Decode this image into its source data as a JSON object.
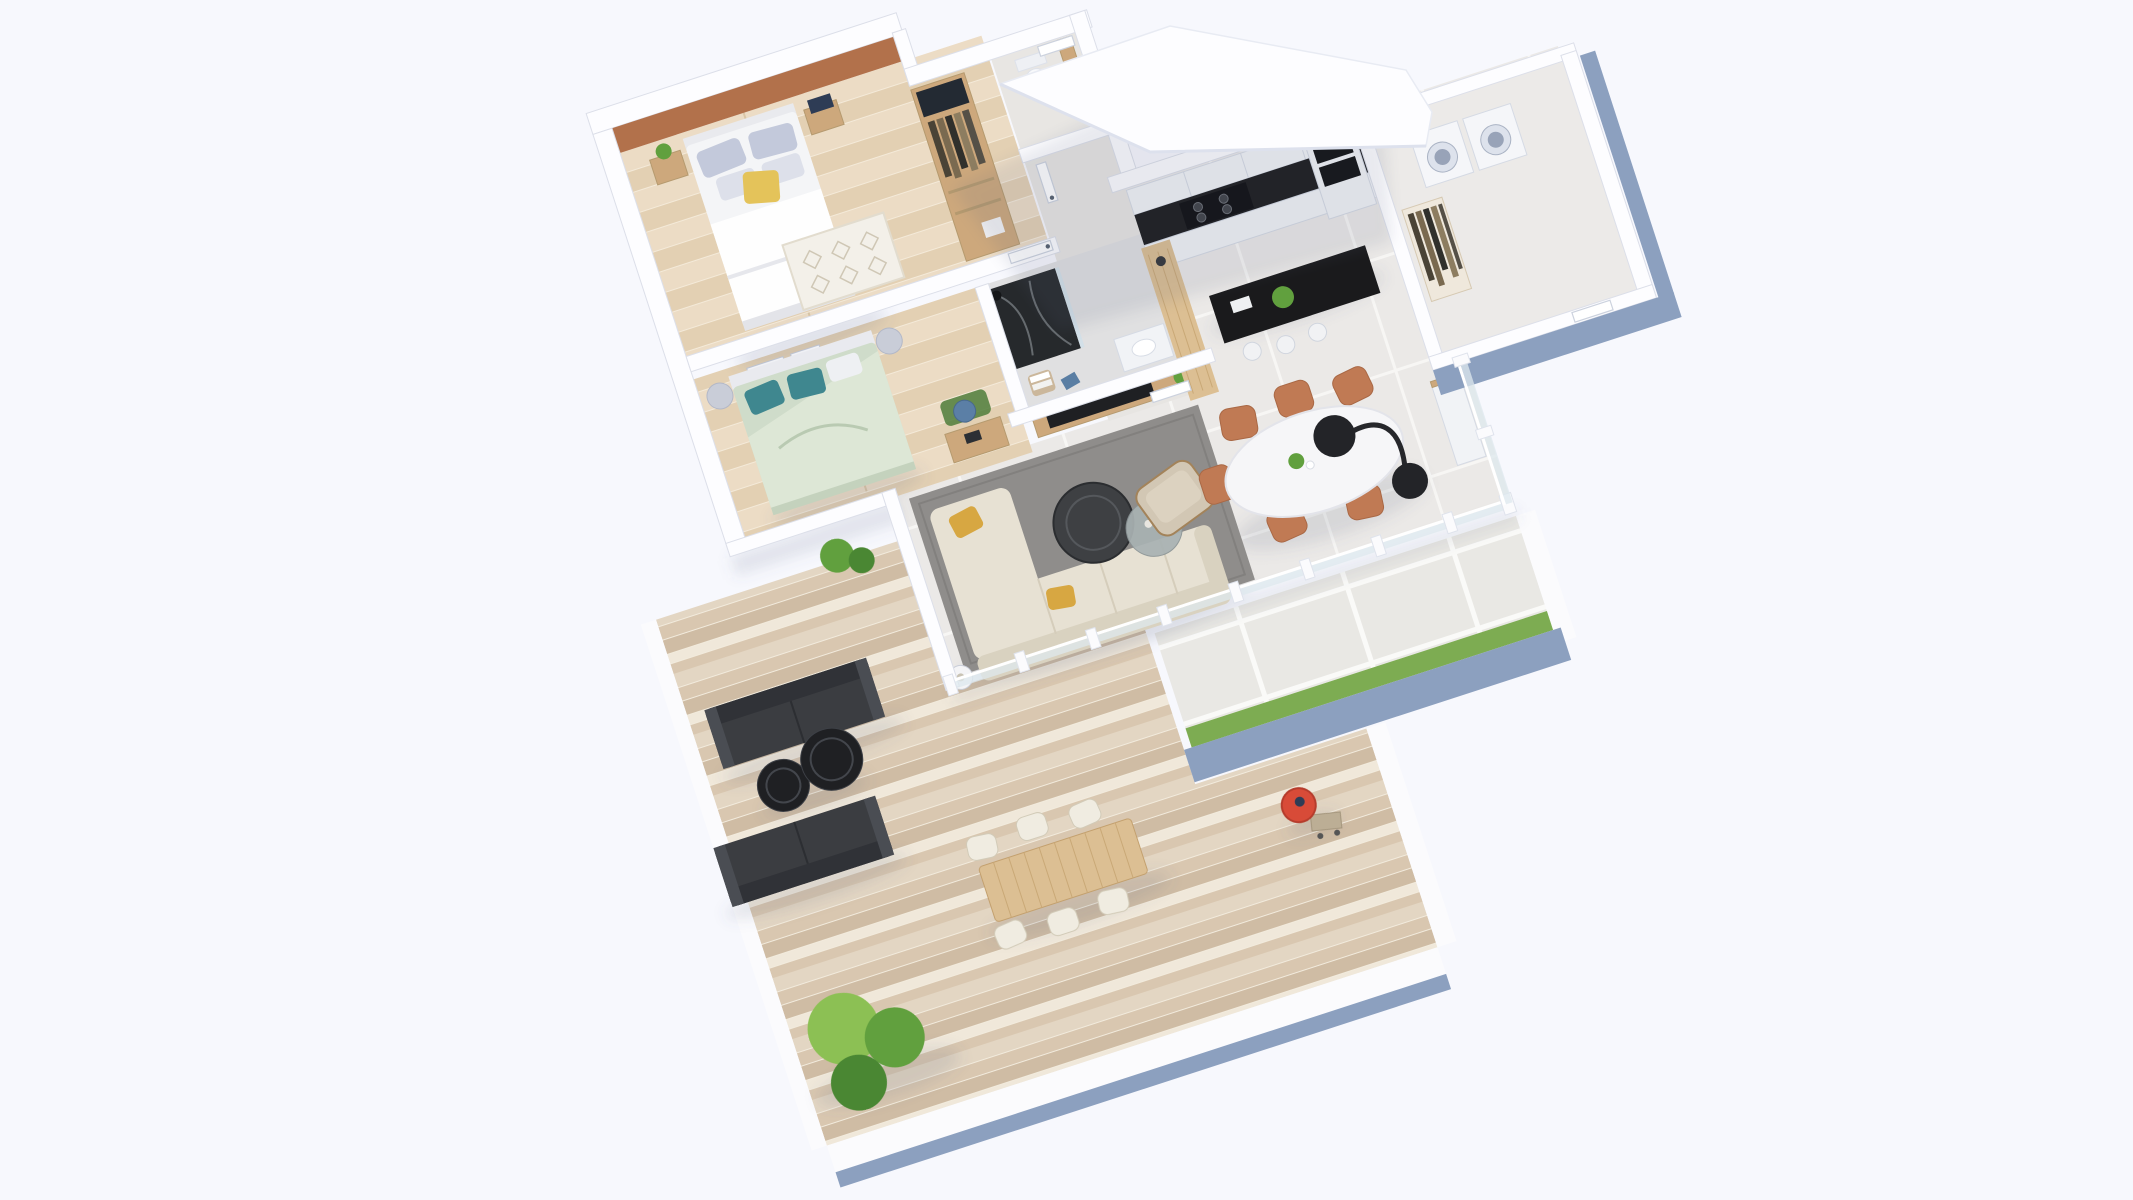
{
  "scene": {
    "type": "isometric-3d-floor-plan-render",
    "description": "Photorealistic 3D floor plan of an apartment with two bedrooms, bathroom, WC, kitchen, laundry room, open living-dining area, large wooden terrace deck and paver patio, viewed from above at an angle, rotated about -18 degrees on a pale background. No text labels are visible.",
    "rotation_deg": -18,
    "palette": {
      "background": "#f7f8fd",
      "wallTop": "#fdfdff",
      "slate": "#8ca0bf",
      "orange": "#b2714b",
      "tileFloor": "#ebe9e7",
      "hallFloor": "#e7e5e2",
      "woodFloorA": "#ecdcc5",
      "woodFloorB": "#e3d0b3",
      "deckA": "#e3d6c3",
      "deckB": "#d9c7b0",
      "deckC": "#cfbca4",
      "deckD": "#f0e8da",
      "paver": "#e9e8e4",
      "grass": "#7dac52",
      "rugGray": "#8f8d8b",
      "rugWhite": "#f3f0e9",
      "sofaCream": "#e7e1d3",
      "sofaCreamDark": "#d9d2c0",
      "mustard": "#d7a742",
      "bedWhite": "#f4f5f7",
      "pillowBlue": "#c3c9db",
      "pillowYellow": "#e4c35a",
      "sage": "#cfdcca",
      "teal": "#3f878f",
      "counterBlack": "#1a1a1c",
      "cabinetWhite": "#f1f3f6",
      "woodCounter": "#dcbf93",
      "woodFurn": "#cda87c",
      "chairTerracotta": "#c07a54",
      "charcoal": "#3b3d41",
      "black": "#1f2023",
      "grillRed": "#d84b38",
      "treeA": "#8cc054",
      "treeB": "#61a03e",
      "treeC": "#4a8733",
      "glass": "#dde8ee",
      "marbleDark": "#26292c"
    },
    "rooms": [
      {
        "id": "bedroom-1",
        "name": "Main bedroom",
        "features": [
          "terracotta accent wall",
          "double bed with white duvet",
          "blue-gray pillows",
          "yellow accent pillow",
          "two nightstands",
          "plant",
          "white diamond-pattern rug",
          "wooden wardrobe with clothes",
          "wood plank floor"
        ]
      },
      {
        "id": "bedroom-2",
        "name": "Second bedroom",
        "features": [
          "double bed with sage duvet",
          "teal pillows",
          "round nightstands",
          "wall art frames",
          "desk with blue chair",
          "green rug",
          "wood plank floor"
        ]
      },
      {
        "id": "bathroom",
        "name": "Bathroom",
        "features": [
          "dark marble shower",
          "glass screen",
          "white vanity with sink",
          "stool with towels"
        ]
      },
      {
        "id": "wc",
        "name": "WC",
        "features": [
          "toilet",
          "shelf"
        ]
      },
      {
        "id": "hallway",
        "name": "Entry hall",
        "features": [
          "tiled floor",
          "interior doors"
        ]
      },
      {
        "id": "kitchen",
        "name": "Kitchen",
        "features": [
          "white upper cabinets",
          "black countertop with 4-burner cooktop",
          "tall unit with double oven",
          "black island with plant and sink",
          "white bar stools",
          "wood bar counter"
        ]
      },
      {
        "id": "laundry-room",
        "name": "Laundry room",
        "features": [
          "washer",
          "dryer",
          "open closet with hanging clothes"
        ]
      },
      {
        "id": "living-room",
        "name": "Living room",
        "features": [
          "gray area rug",
          "cream L-shaped sectional sofa",
          "mustard pillows",
          "two round coffee tables",
          "taupe armchair",
          "TV wall console",
          "floor lamp"
        ]
      },
      {
        "id": "dining-area",
        "name": "Dining area",
        "features": [
          "white oval table",
          "6 terracotta chairs",
          "black arc floor lamp",
          "sideboard",
          "tiled floor"
        ]
      }
    ],
    "outdoor": {
      "terrace_deck": [
        "wood plank decking",
        "two charcoal outdoor sofas",
        "two round black coffee tables",
        "outdoor wooden dining table with 6 light chairs",
        "red kettle BBQ grill with cart",
        "group of three green trees",
        "green shrub"
      ],
      "paver_patio": [
        "large concrete pavers",
        "grass strip along edge",
        "slate-blue fascia"
      ],
      "balustrade": "white posts with glass panels between interior floor and terrace",
      "roof_slab": "white roof slab covering the entry zone"
    }
  }
}
